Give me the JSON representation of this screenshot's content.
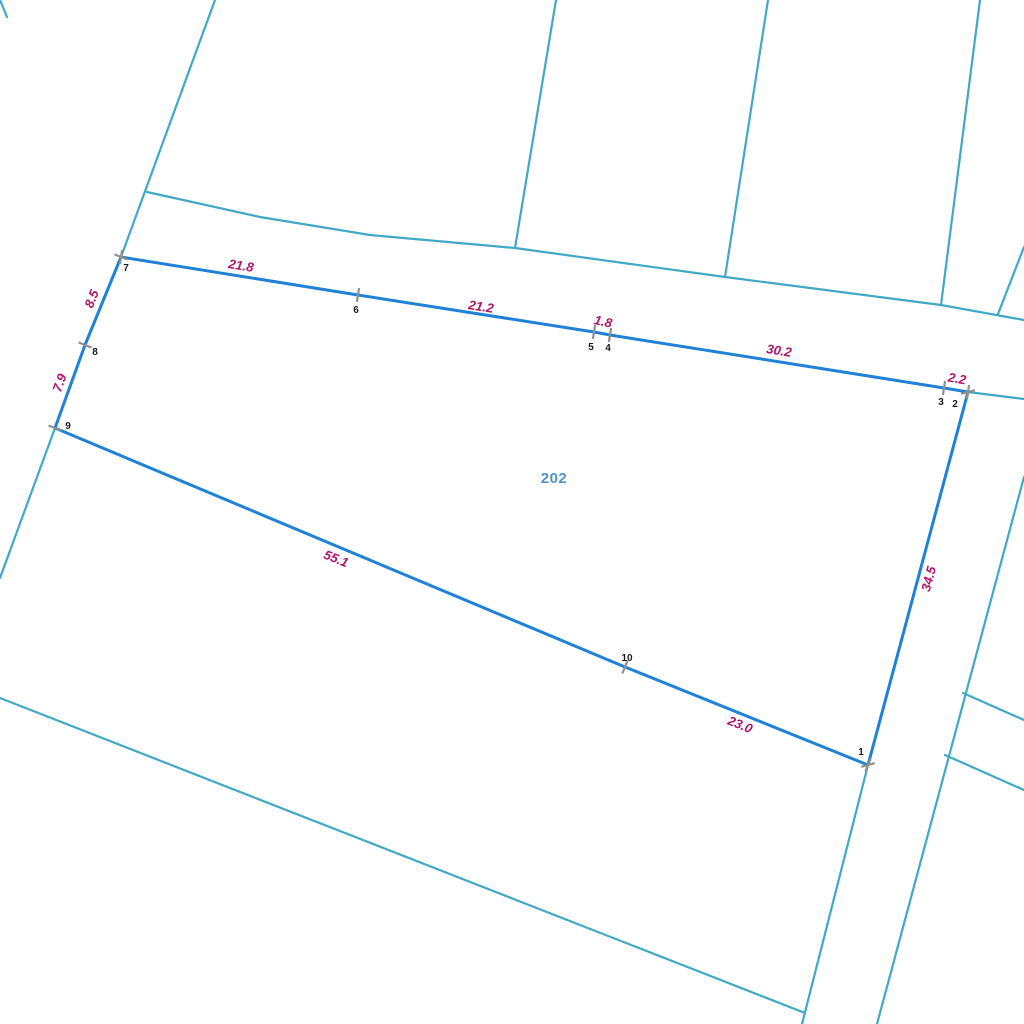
{
  "canvas": {
    "width": 1024,
    "height": 1024,
    "background": "#ffffff"
  },
  "colors": {
    "parcel_boundary": "#1f82d6",
    "background_lines": "#41a8c6",
    "tick": "#8f8f8f",
    "measurement_label": "#b0146b",
    "vertex_label": "#1b1b1b",
    "parcel_number_label": "#4e93c8"
  },
  "map": {
    "background_lines": [
      {
        "name": "northwest-corner-stub-line",
        "points": [
          [
            0,
            0
          ],
          [
            7,
            17
          ]
        ]
      },
      {
        "name": "west-boundary-line",
        "points": [
          [
            215,
            0
          ],
          [
            121,
            257
          ]
        ]
      },
      {
        "name": "west-boundary-extension",
        "points": [
          [
            55,
            428
          ],
          [
            0,
            578
          ]
        ]
      },
      {
        "name": "north-road-line",
        "points": [
          [
            147,
            192
          ],
          [
            260,
            217
          ],
          [
            370,
            235
          ],
          [
            515,
            248
          ],
          [
            725,
            277
          ],
          [
            941,
            305
          ],
          [
            1024,
            320
          ]
        ]
      },
      {
        "name": "north-parcel-line-1",
        "points": [
          [
            556,
            0
          ],
          [
            515,
            248
          ]
        ]
      },
      {
        "name": "north-parcel-line-2",
        "points": [
          [
            768,
            0
          ],
          [
            725,
            277
          ]
        ]
      },
      {
        "name": "north-parcel-line-3",
        "points": [
          [
            980,
            0
          ],
          [
            941,
            305
          ]
        ]
      },
      {
        "name": "northeast-corner-line",
        "points": [
          [
            1024,
            247
          ],
          [
            998,
            314
          ]
        ]
      },
      {
        "name": "north-boundary-extension-east",
        "points": [
          [
            968,
            392
          ],
          [
            1024,
            399
          ]
        ]
      },
      {
        "name": "east-boundary-extension-south",
        "points": [
          [
            868,
            765
          ],
          [
            802,
            1024
          ]
        ]
      },
      {
        "name": "southwest-diagonal-line",
        "points": [
          [
            0,
            698
          ],
          [
            805,
            1013
          ]
        ]
      },
      {
        "name": "southeast-parallel-line",
        "points": [
          [
            1024,
            477
          ],
          [
            877,
            1024
          ]
        ]
      },
      {
        "name": "southeast-branch-line-1",
        "points": [
          [
            963,
            693
          ],
          [
            1024,
            720
          ]
        ]
      },
      {
        "name": "southeast-branch-line-2",
        "points": [
          [
            945,
            755
          ],
          [
            1024,
            790
          ]
        ]
      }
    ]
  },
  "parcel": {
    "number": "202",
    "number_position": {
      "x": 554,
      "y": 483
    },
    "vertices": [
      {
        "n": "1",
        "x": 868,
        "y": 765,
        "label_x": 861,
        "label_y": 752,
        "ticks": [
          -15,
          112
        ]
      },
      {
        "n": "2",
        "x": 968,
        "y": 392,
        "label_x": 955,
        "label_y": 404,
        "ticks": [
          99,
          -15
        ]
      },
      {
        "n": "3",
        "x": 944,
        "y": 388,
        "label_x": 941,
        "label_y": 402,
        "ticks": [
          99
        ]
      },
      {
        "n": "4",
        "x": 610,
        "y": 335,
        "label_x": 608,
        "label_y": 348,
        "ticks": [
          99
        ]
      },
      {
        "n": "5",
        "x": 594,
        "y": 332,
        "label_x": 591,
        "label_y": 347,
        "ticks": [
          99
        ]
      },
      {
        "n": "6",
        "x": 358,
        "y": 295,
        "label_x": 356,
        "label_y": 310,
        "ticks": [
          99
        ]
      },
      {
        "n": "7",
        "x": 121,
        "y": 257,
        "label_x": 126,
        "label_y": 268,
        "ticks": [
          22,
          99
        ]
      },
      {
        "n": "8",
        "x": 85,
        "y": 345,
        "label_x": 95,
        "label_y": 352,
        "ticks": [
          22
        ]
      },
      {
        "n": "9",
        "x": 55,
        "y": 428,
        "label_x": 68,
        "label_y": 426,
        "ticks": [
          20
        ]
      },
      {
        "n": "10",
        "x": 625,
        "y": 667,
        "label_x": 627,
        "label_y": 658,
        "ticks": [
          112
        ]
      }
    ],
    "measurements": [
      {
        "value": "21.8",
        "x": 241,
        "y": 266,
        "angle": 9
      },
      {
        "value": "21.2",
        "x": 481,
        "y": 307,
        "angle": 9
      },
      {
        "value": "1.8",
        "x": 603,
        "y": 322,
        "angle": 12
      },
      {
        "value": "30.2",
        "x": 779,
        "y": 351,
        "angle": 9
      },
      {
        "value": "2.2",
        "x": 957,
        "y": 379,
        "angle": 10
      },
      {
        "value": "34.5",
        "x": 929,
        "y": 579,
        "angle": -75
      },
      {
        "value": "23.0",
        "x": 740,
        "y": 725,
        "angle": 22
      },
      {
        "value": "55.1",
        "x": 336,
        "y": 559,
        "angle": 22
      },
      {
        "value": "7.9",
        "x": 60,
        "y": 383,
        "angle": -70
      },
      {
        "value": "8.5",
        "x": 92,
        "y": 299,
        "angle": -68
      }
    ]
  }
}
